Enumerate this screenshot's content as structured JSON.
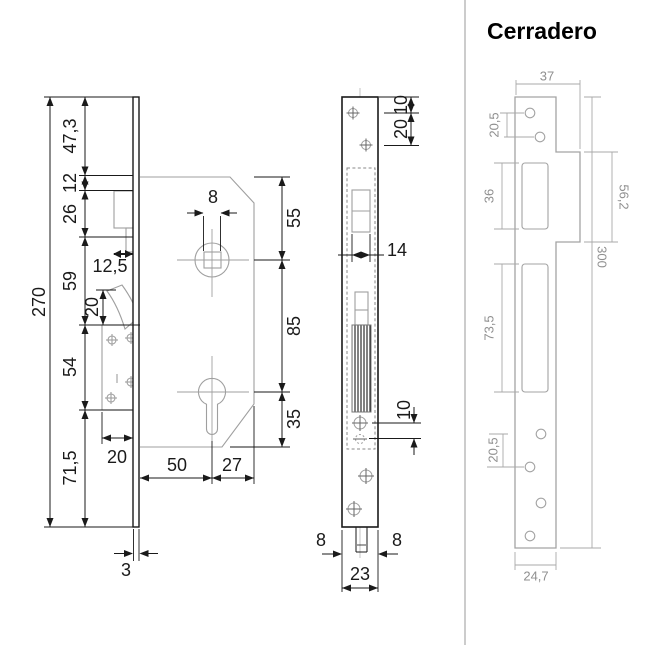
{
  "colors": {
    "ink": "#1a1a1a",
    "light_line": "#9f9f9f",
    "gray_line": "#a3a3a3",
    "gray_text": "#8f8f8f",
    "divider": "#cccccc",
    "background": "#ffffff"
  },
  "left_view": {
    "label": "lock side view",
    "total_height": "270",
    "chain": [
      "47,3",
      "12",
      "26",
      "59",
      "54",
      "71,5"
    ],
    "offset": "12,5",
    "hook_height": "20",
    "case_depth": "20",
    "spindle_hole": "8",
    "right_chain": [
      "55",
      "85",
      "35"
    ],
    "backset": "50",
    "center_to_edge": "27",
    "plate_thickness": "3"
  },
  "front_view": {
    "label": "lock faceplate front view",
    "edge_to_first_hole": "10",
    "hole_spacing": "20",
    "latch_width": "14",
    "lower_hole_spacing": "10",
    "side_margin_left": "8",
    "side_margin_right": "8",
    "plate_width": "23"
  },
  "strike_view": {
    "title": "Cerradero",
    "top_width": "37",
    "top_hole_spacing": "20,5",
    "latch_slot_height": "36",
    "lip_height": "56,2",
    "total_height": "300",
    "bolt_slot_height": "73,5",
    "bottom_hole_spacing": "20,5",
    "bottom_width": "24,7"
  }
}
